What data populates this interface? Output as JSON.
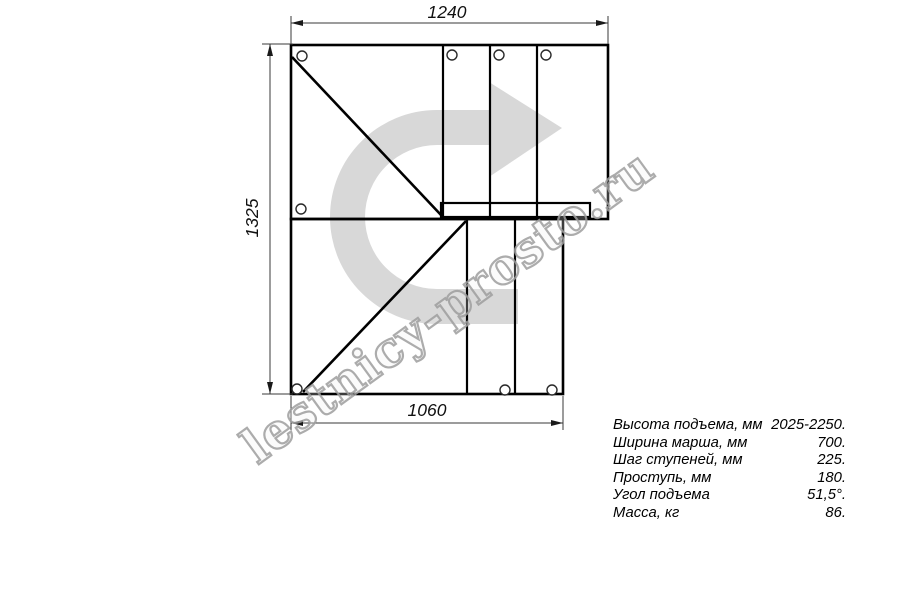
{
  "drawing": {
    "title_semantic": "staircase-plan-top-view",
    "watermark": "lestnicy-prosto.ru",
    "dimensions": {
      "top_width": "1240",
      "left_height": "1325",
      "bottom_width": "1060"
    },
    "icons": {
      "direction_arrow": "u-turn-right-arrow"
    },
    "colors": {
      "line": "#000000",
      "dim_line": "#3a3a3a",
      "arrow_fill": "#d8d8d8",
      "watermark_outline": "#9e9e9e"
    }
  },
  "specs": {
    "rows": [
      {
        "label": "Высота подъема, мм",
        "value": "2025-2250."
      },
      {
        "label": "Ширина марша, мм",
        "value": "700."
      },
      {
        "label": "Шаг ступеней, мм",
        "value": "225."
      },
      {
        "label": "Проступь, мм",
        "value": "180."
      },
      {
        "label": "Угол подъема",
        "value": "51,5°."
      },
      {
        "label": "Масса, кг",
        "value": "86."
      }
    ]
  }
}
